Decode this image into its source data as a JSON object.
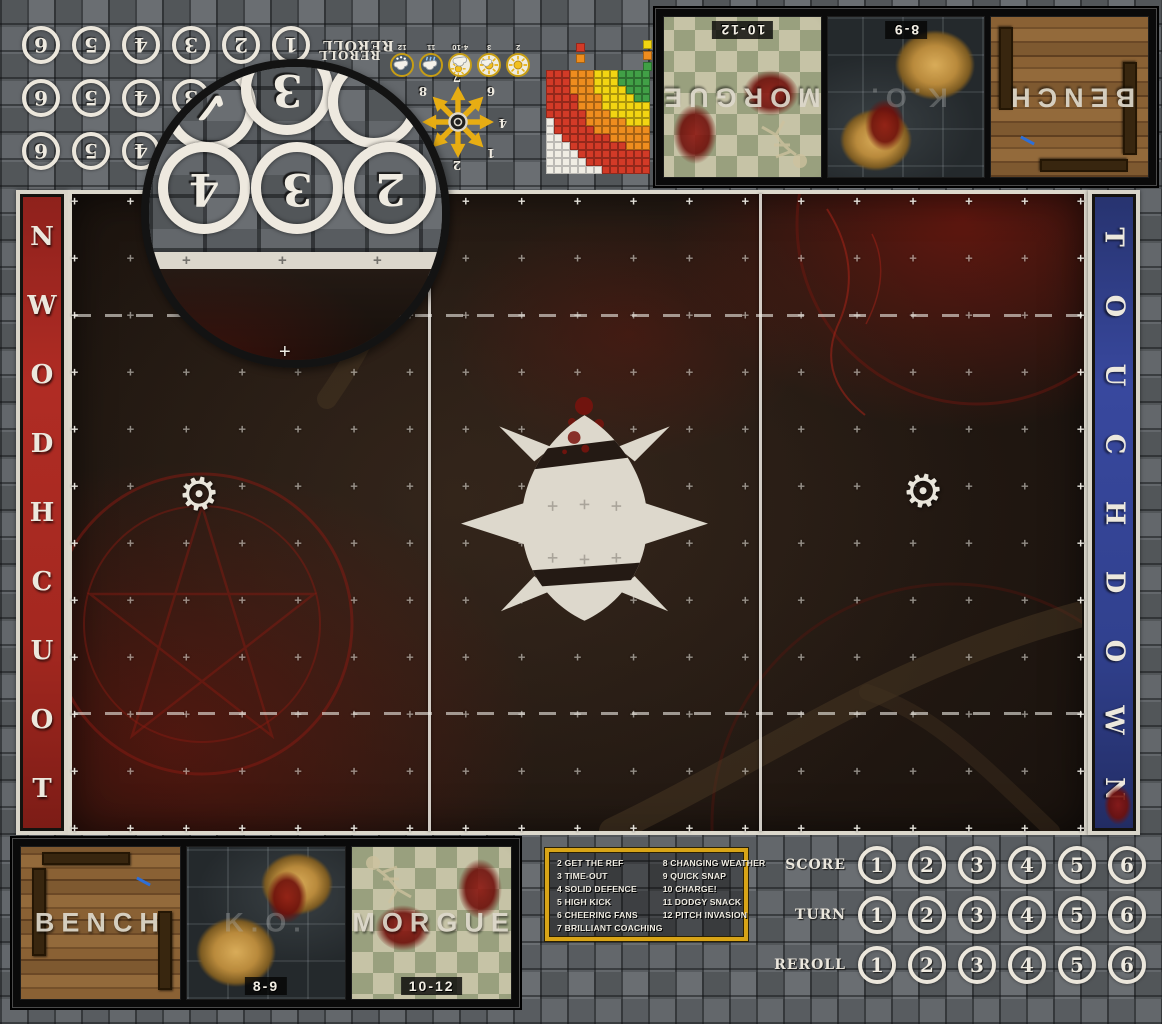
{
  "endzones": {
    "left": {
      "label": "TOUCHDOWN",
      "color": "#a42820"
    },
    "right": {
      "label": "TOUCHDOWN",
      "color": "#31418f"
    }
  },
  "score_block": {
    "rows": [
      {
        "label": "SCORE",
        "values": [
          "1",
          "2",
          "3",
          "4",
          "5",
          "6"
        ]
      },
      {
        "label": "TURN",
        "values": [
          "1",
          "2",
          "3",
          "4",
          "5",
          "6"
        ]
      },
      {
        "label": "REROLL",
        "values": [
          "1",
          "2",
          "3",
          "4",
          "5",
          "6"
        ]
      }
    ]
  },
  "dugout": {
    "bench_label": "BENCH",
    "ko_label": "K.O.",
    "ko_range": "8-9",
    "morgue_label": "MORGUE",
    "morgue_range": "10-12"
  },
  "kickoff_table": {
    "border_color": "#d8a417",
    "column1": [
      "2 GET THE REF",
      "3 TIME-OUT",
      "4 SOLID DEFENCE",
      "5 HIGH KICK",
      "6 CHEERING FANS",
      "7 BRILLIANT COACHING"
    ],
    "column2": [
      "8 CHANGING WEATHER",
      "9 QUICK SNAP",
      "10 CHARGE!",
      "11 DODGY SNACK",
      "12 PITCH INVASION"
    ]
  },
  "weather_track": {
    "reroll_label": "REROLL",
    "items": [
      {
        "label": "2",
        "icon": "sun-icon"
      },
      {
        "label": "3",
        "icon": "sunny-cloud-icon"
      },
      {
        "label": "4-10",
        "icon": "sun-behind-cloud-icon"
      },
      {
        "label": "11",
        "icon": "rain-cloud-icon"
      },
      {
        "label": "12",
        "icon": "snow-cloud-icon"
      }
    ]
  },
  "direction_template": {
    "numbers": [
      "1",
      "2",
      "3",
      "4",
      "5",
      "6",
      "7",
      "8"
    ],
    "arrow_color": "#e7ad13"
  },
  "pass_range_chart": {
    "palette": {
      "G": "#41a046",
      "Y": "#f2d512",
      "O": "#ee8d1e",
      "R": "#d23a27",
      "W": "#f0ede4"
    },
    "grid": [
      "RRROOOYYYGGGG",
      "RRROOOYYYGGGG",
      "RRROOOYYYYGGG",
      "RRRROOOYYYYGG",
      "RRRROOOYYYYYY",
      "RRRRROOOYYYYY",
      "WRRRROOOOOYYY",
      "WRRRRROOOOOOO",
      "WWRRRRRROOOOO",
      "WWWRRRRRRROOO",
      "WWWWRRRRRRRRR",
      "WWWWWRRRRRRRR",
      "WWWWWWWRRRRRR"
    ],
    "legend_left": [
      "R",
      "O"
    ],
    "legend_right": [
      "Y",
      "O",
      "G"
    ]
  },
  "magnifier_detail": {
    "big_numbers": [
      "4",
      "3",
      "2"
    ],
    "partial_top": [
      "✓",
      "3"
    ]
  }
}
